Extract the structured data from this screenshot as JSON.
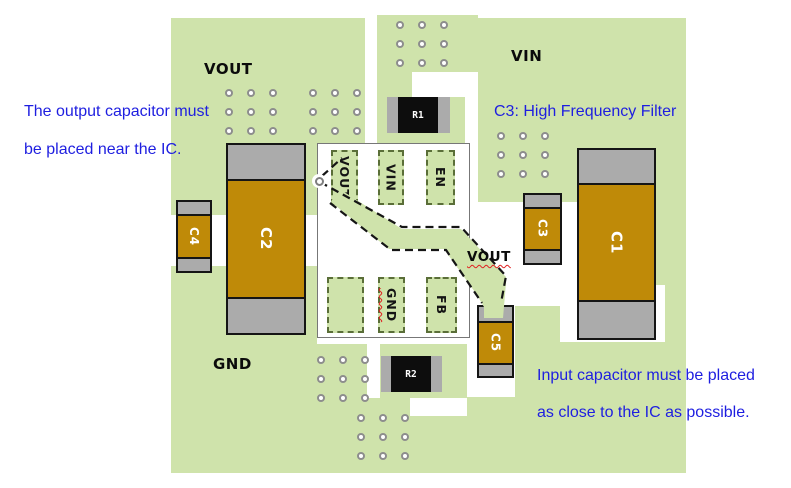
{
  "annotations": {
    "output_cap": {
      "line1": "The output capacitor must",
      "line2": "be placed near the IC."
    },
    "c3_filter": {
      "text": "C3: High Frequency Filter"
    },
    "input_cap": {
      "line1": "Input capacitor must be placed",
      "line2": "as close to the IC as possible."
    }
  },
  "board_labels": {
    "vout_top": "VOUT",
    "vin": "VIN",
    "gnd": "GND",
    "vout_route": "VOUT"
  },
  "ic": {
    "pins": [
      {
        "label": "VOUT"
      },
      {
        "label": "VIN"
      },
      {
        "label": "EN"
      },
      {
        "label": ""
      },
      {
        "label": "GND"
      },
      {
        "label": "FB"
      }
    ]
  },
  "components": {
    "c1": "C1",
    "c2": "C2",
    "c3": "C3",
    "c4": "C4",
    "c5": "C5",
    "r1": "R1",
    "r2": "R2"
  },
  "colors": {
    "board_green": "#cfe3ab",
    "component_orange": "#bf8a08",
    "pad_gray": "#ababab",
    "annotation_blue": "#1e1ee0",
    "resistor_black": "#0d0d0d"
  }
}
